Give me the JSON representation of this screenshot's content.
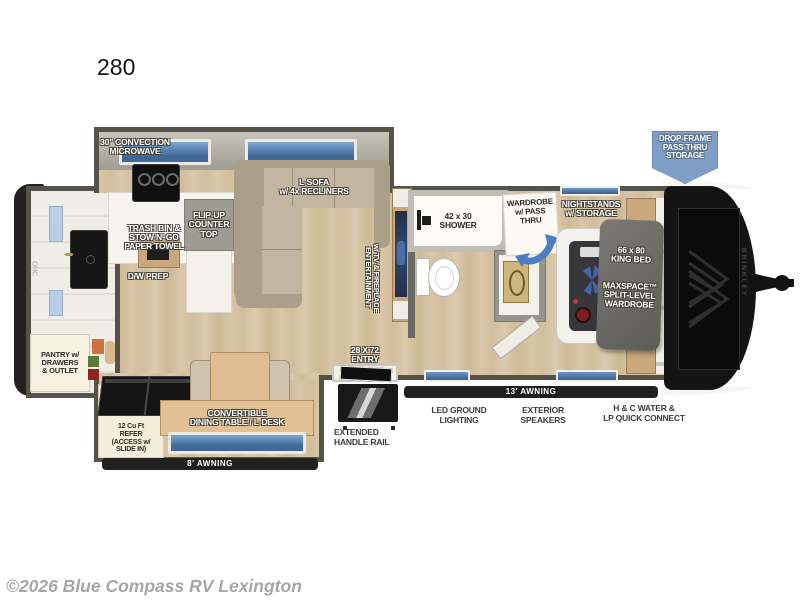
{
  "title": "280",
  "watermark": "©2026 Blue Compass RV Lexington",
  "brand": {
    "name": "BRINKLEY"
  },
  "badge": {
    "drop_frame_storage": "DROP-FRAME\nPASS-THRU\nSTORAGE",
    "color": "#7e9ec6"
  },
  "kitchen": {
    "microwave": "30\" CONVECTION\nMICROWAVE",
    "flip_up_counter": "FLIP-UP\nCOUNTER\nTOP",
    "trash_bin": "TRASH BIN &\nSTOW N' GO\nPAPER TOWEL",
    "dw_prep": "D/W PREP",
    "pantry": "PANTRY w/\nDRAWERS\n& OUTLET",
    "ohc": "OHC"
  },
  "living": {
    "sofa": "L-SOFA\nw/ 4x RECLINERS",
    "entertainment": "ENTERTAINMENT\nw/ TV & FIREPLACE",
    "dinette": "CONVERTIBLE\nDINING TABLE / L-DESK",
    "refrigerator": "12 Cu Ft\nREFER\n(ACCESS w/\nSLIDE IN)"
  },
  "bathroom": {
    "shower": "42 x 30\nSHOWER",
    "wardrobe_pass_thru": "WARDROBE\nw/ PASS\nTHRU"
  },
  "bedroom": {
    "nightstands": "NIGHTSTANDS\nw/ STORAGE",
    "king_bed": "66 x 80\nKING BED",
    "wardrobe": "MAXSPACE™\nSPLIT-LEVEL\nWARDROBE"
  },
  "exterior": {
    "entry": "28 X 72\nENTRY",
    "awning_small": "8'  AWNING",
    "awning_large": "13'  AWNING",
    "extended_handle_rail": "EXTENDED\nHANDLE RAIL",
    "led_ground_lighting": "LED GROUND\nLIGHTING",
    "exterior_speakers": "EXTERIOR\nSPEAKERS",
    "water_lp_connect": "H & C WATER &\nLP QUICK CONNECT"
  },
  "colors": {
    "wall": "#55524a",
    "floor": "#d8c6a8",
    "window_glass": "#4a74a6",
    "badge_blue": "#7e9ec6",
    "front_cap": "#141414",
    "watermark_gray": "#a6a6a6"
  }
}
